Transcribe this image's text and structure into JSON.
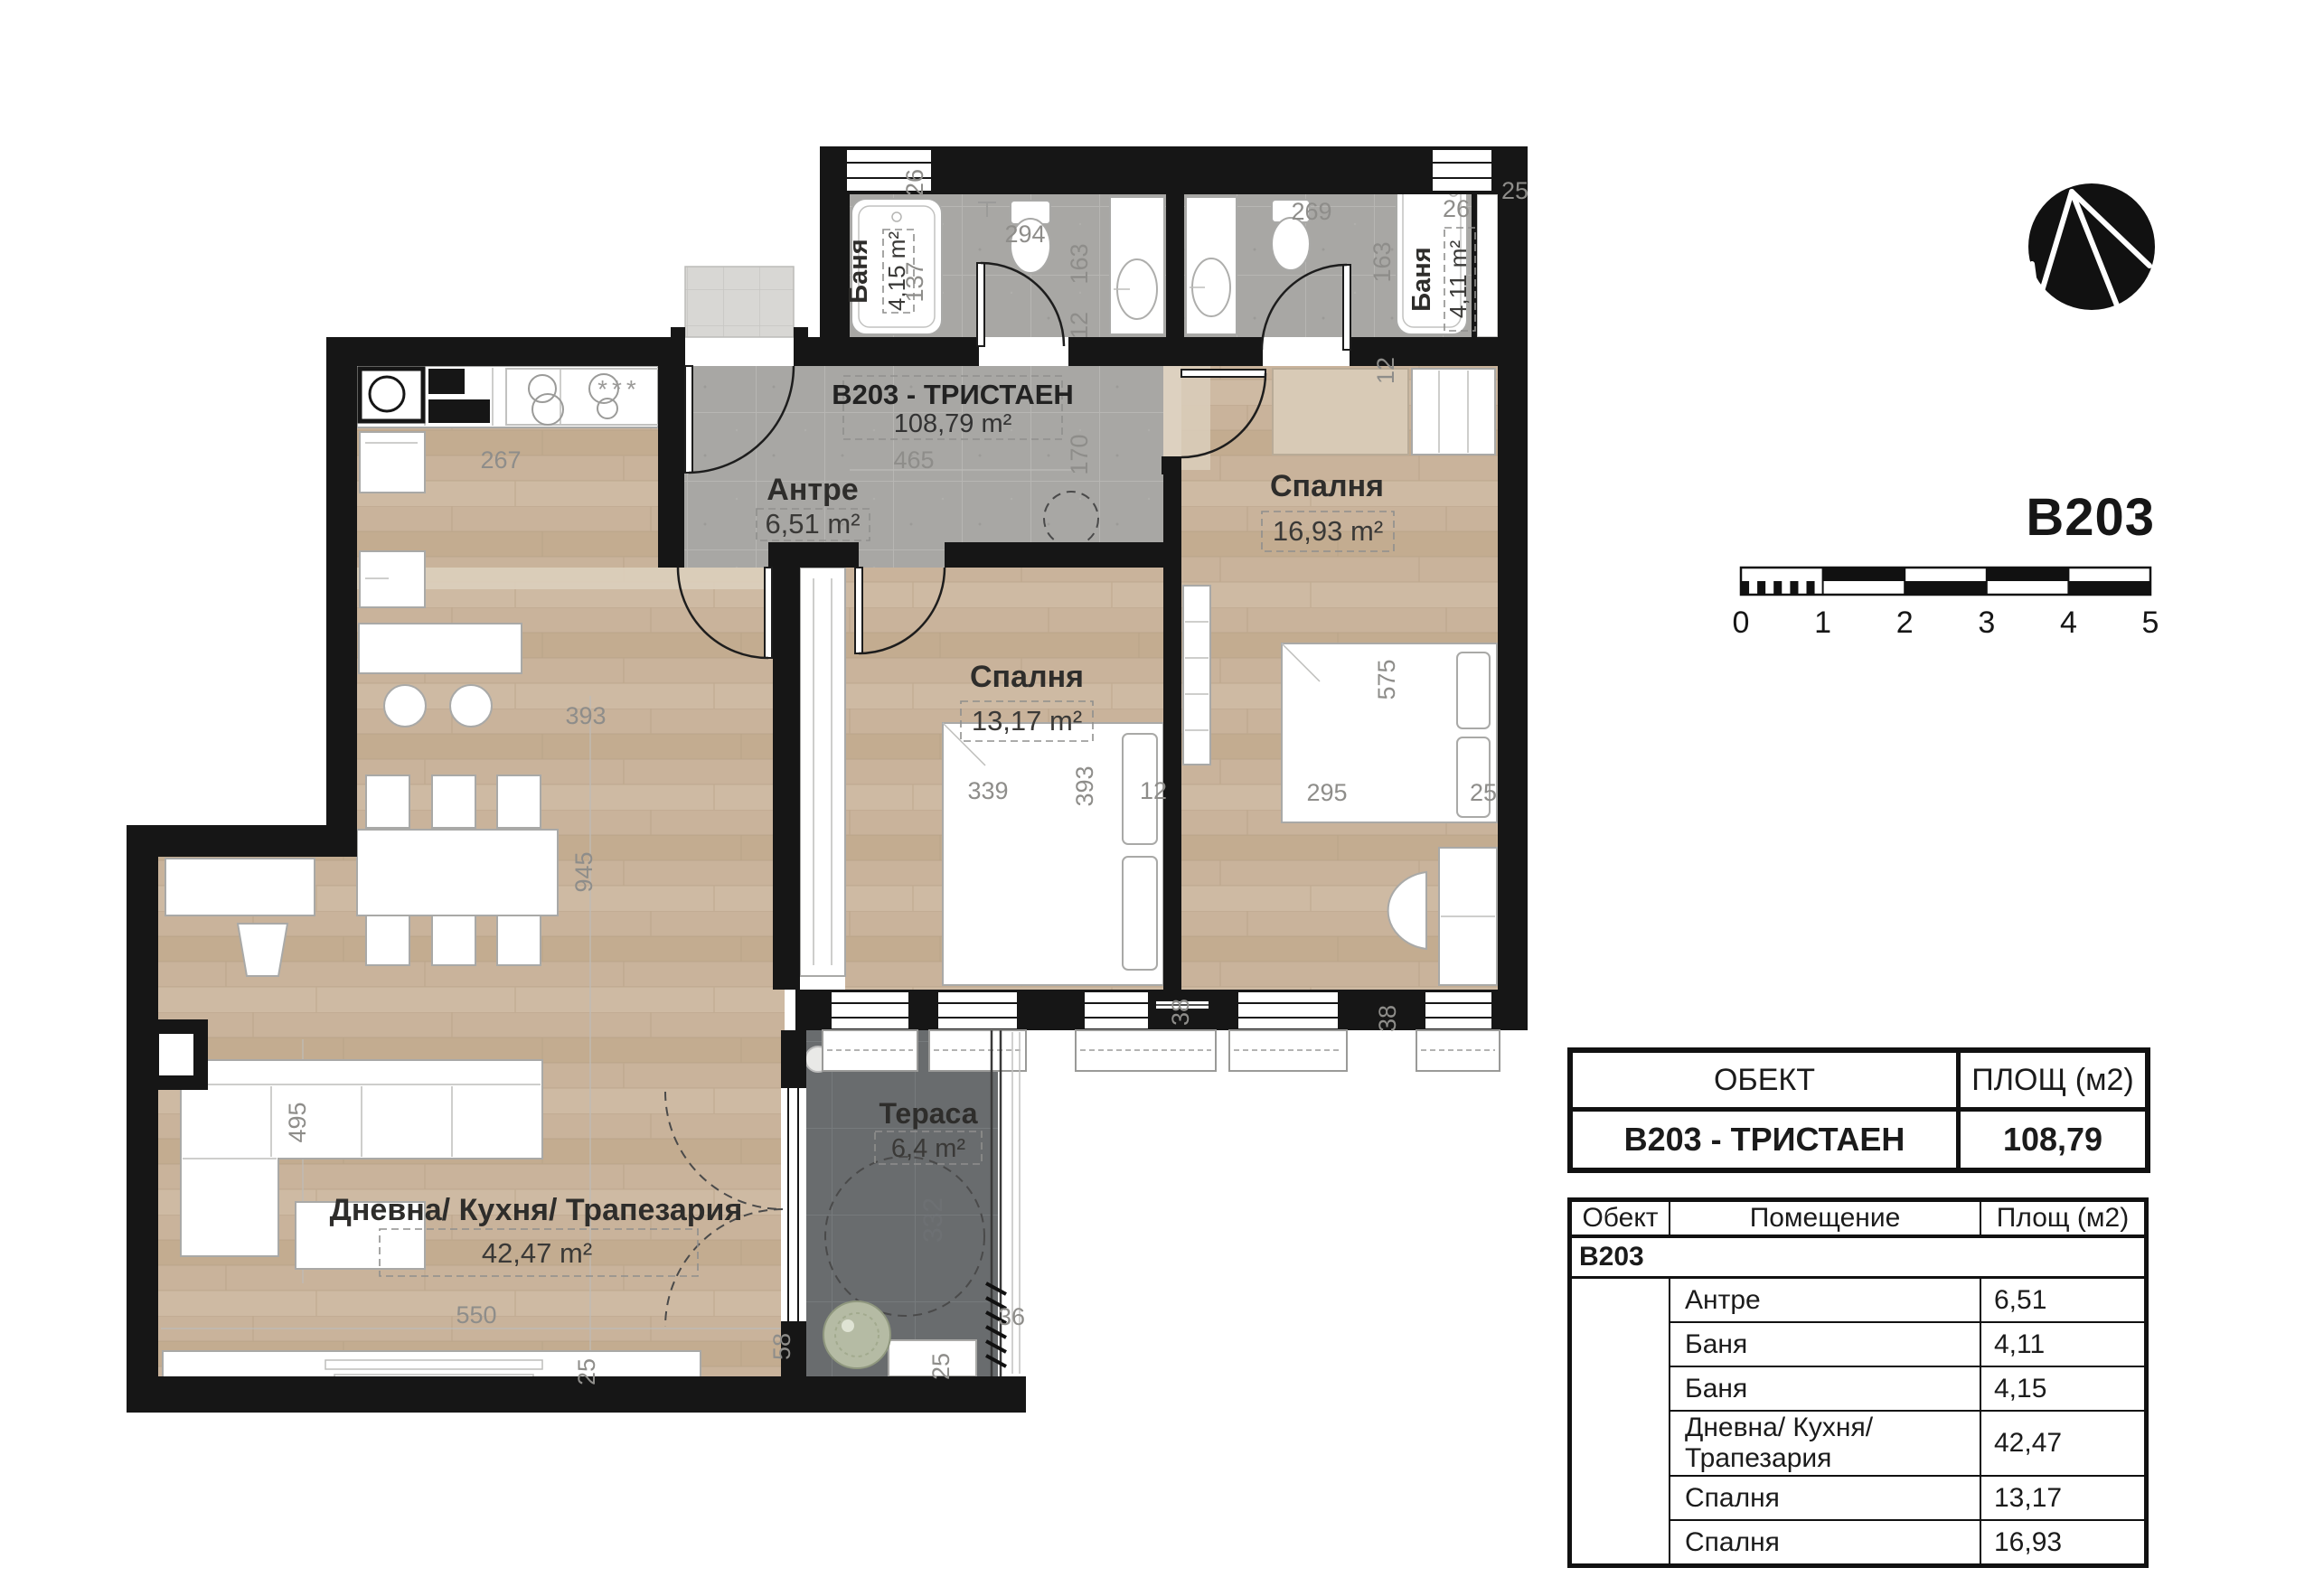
{
  "unit": {
    "code": "B203",
    "title": "B203 - ТРИСТАЕН",
    "area": "108,79 m²"
  },
  "rooms": {
    "bath_left": {
      "name": "Баня",
      "area": "4,15 m²"
    },
    "bath_right": {
      "name": "Баня",
      "area": "4,11 m²"
    },
    "antre": {
      "name": "Антре",
      "area": "6,51 m²"
    },
    "bedroom_right": {
      "name": "Спалня",
      "area": "16,93 m²"
    },
    "bedroom_mid": {
      "name": "Спалня",
      "area": "13,17 m²"
    },
    "living": {
      "name": "Дневна/ Кухня/ Трапезария",
      "area": "42,47 m²"
    },
    "terrace": {
      "name": "Тераса",
      "area": "6,4 m²"
    }
  },
  "dims": {
    "d26_l": "26",
    "d294": "294",
    "d137": "137",
    "d163_l": "163",
    "d12_l": "12",
    "d269": "269",
    "d163_r": "163",
    "d26_r": "26",
    "d25_top": "25",
    "d12_r": "12",
    "d465": "465",
    "d170": "170",
    "d267": "267",
    "d393_liv": "393",
    "d945": "945",
    "d495": "495",
    "d550": "550",
    "d25_liv": "25",
    "d339": "339",
    "d393_bed": "393",
    "d12_bed": "12",
    "d295": "295",
    "d575": "575",
    "d25_bed": "25",
    "d38_a": "38",
    "d38_b": "38",
    "d36": "36",
    "d25_ter": "25",
    "d58": "58",
    "d332": "332"
  },
  "kitchen_marks": "***",
  "scale_bar": {
    "ticks": [
      "0",
      "1",
      "2",
      "3",
      "4",
      "5"
    ]
  },
  "tables": {
    "summary": {
      "col1": "ОБЕКТ",
      "col2": "ПЛОЩ (м2)",
      "row_name": "B203 - ТРИСТАЕН",
      "row_area": "108,79"
    },
    "rooms": {
      "h1": "Обект",
      "h2": "Помещение",
      "h3": "Площ (м2)",
      "group": "B203",
      "rows": [
        {
          "name": "Антре",
          "area": "6,51"
        },
        {
          "name": "Баня",
          "area": "4,11"
        },
        {
          "name": "Баня",
          "area": "4,15"
        },
        {
          "name": "Дневна/ Кухня/ Трапезария",
          "area": "42,47"
        },
        {
          "name": "Спалня",
          "area": "13,17"
        },
        {
          "name": "Спалня",
          "area": "16,93"
        }
      ]
    }
  }
}
